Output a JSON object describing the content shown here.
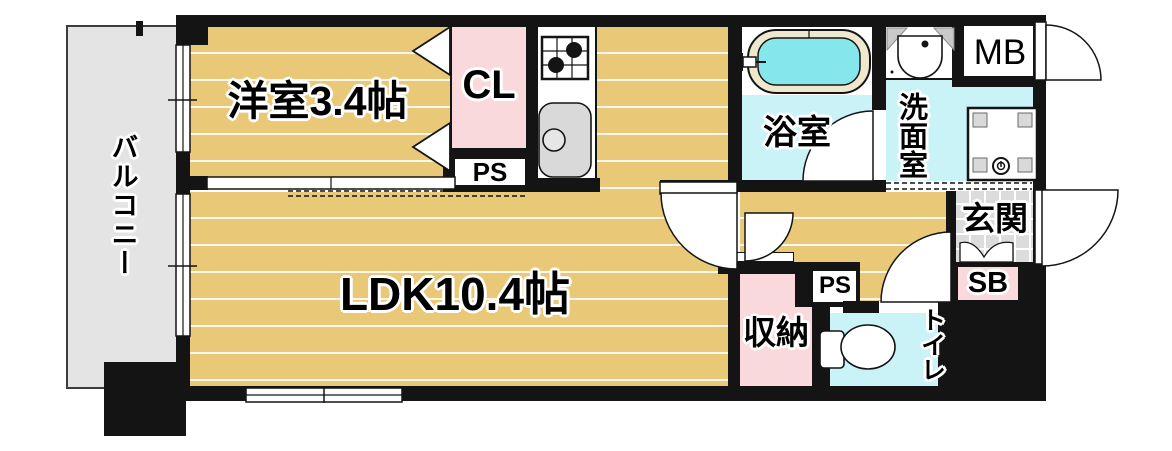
{
  "title": "apartment-floor-plan",
  "rooms": {
    "balcony": {
      "label": "バルコニー"
    },
    "western": {
      "label": "洋室3.4帖"
    },
    "closet": {
      "label": "CL"
    },
    "pipe_space_upper": {
      "label": "PS"
    },
    "ldk": {
      "label": "LDK10.4帖"
    },
    "bath": {
      "label": "浴室"
    },
    "washroom": {
      "label": "洗面室"
    },
    "meter_box": {
      "label": "MB"
    },
    "entrance": {
      "label": "玄関"
    },
    "shoe_box": {
      "label": "SB"
    },
    "storage": {
      "label": "収納"
    },
    "pipe_space_lower": {
      "label": "PS"
    },
    "toilet": {
      "label": "トイレ"
    }
  },
  "icons": [
    "bathtub-icon",
    "bath-faucet-icon",
    "vanity-sink-icon",
    "washer-pan-icon",
    "toilet-icon",
    "gas-stove-icon",
    "kitchen-sink-icon",
    "door-swing-icon",
    "sliding-door-icon",
    "folding-door-icon",
    "window-icon",
    "entrance-step-icon"
  ],
  "colors": {
    "wood_floor": "#e9c878",
    "wet_area_floor": "#c9f3f6",
    "bath_water": "#85e6ec",
    "closet_pink": "#f9d9dc",
    "balcony_gray": "#e4e4e4",
    "entrance_tile": "#dcdcdc",
    "fixture_gray": "#d9d9d9",
    "wall": "#141414"
  }
}
